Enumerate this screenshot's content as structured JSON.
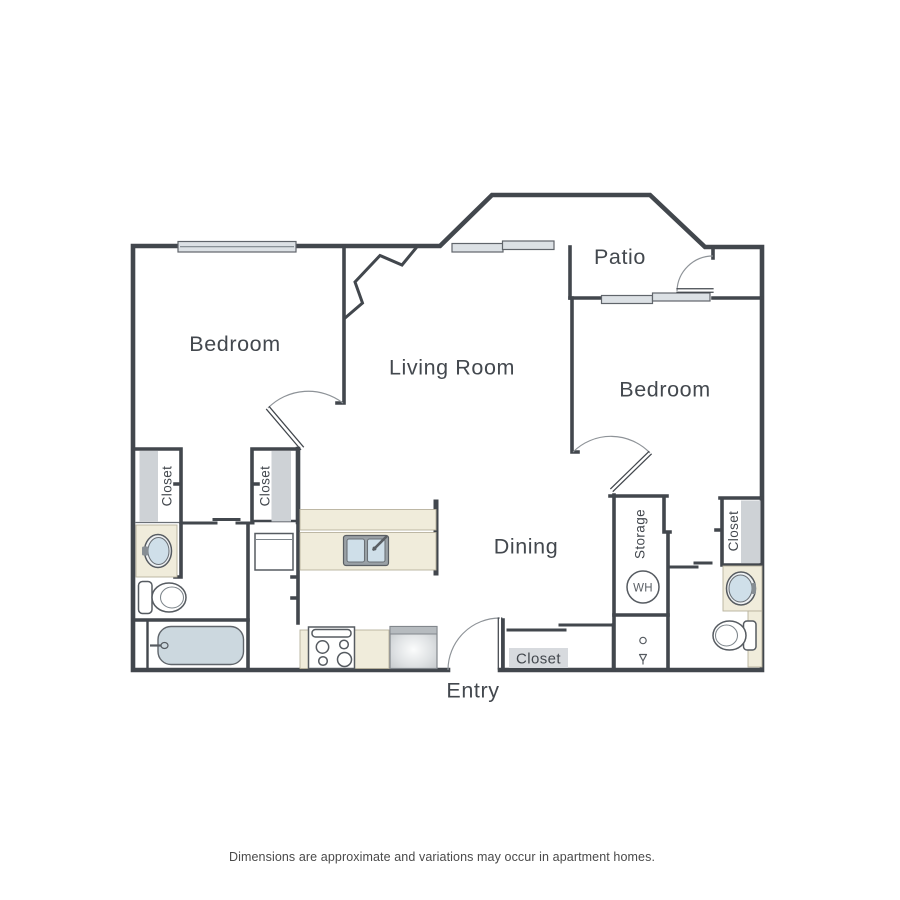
{
  "caption": "Dimensions are approximate and variations may occur in apartment homes.",
  "rooms": {
    "bedroom_left": {
      "label": "Bedroom"
    },
    "living_room": {
      "label": "Living Room"
    },
    "patio": {
      "label": "Patio"
    },
    "bedroom_right": {
      "label": "Bedroom"
    },
    "dining": {
      "label": "Dining"
    },
    "entry": {
      "label": "Entry"
    }
  },
  "closets": {
    "left_a": {
      "label": "Closet"
    },
    "left_b": {
      "label": "Closet"
    },
    "right": {
      "label": "Closet"
    },
    "entry": {
      "label": "Closet"
    }
  },
  "utility": {
    "storage": {
      "label": "Storage"
    },
    "water_heater": {
      "label": "WH"
    }
  },
  "colors": {
    "wall": "#42474d",
    "text": "#43484e",
    "caption_text": "#4a4a4a",
    "window_fill": "#dce1e5",
    "closet_fill": "#ced2d6",
    "counter_fill": "#f0ecdb",
    "tub_fill": "#ccd8df",
    "basin_fill": "#cfdfe9",
    "appliance_gray": "#c7cbce"
  }
}
